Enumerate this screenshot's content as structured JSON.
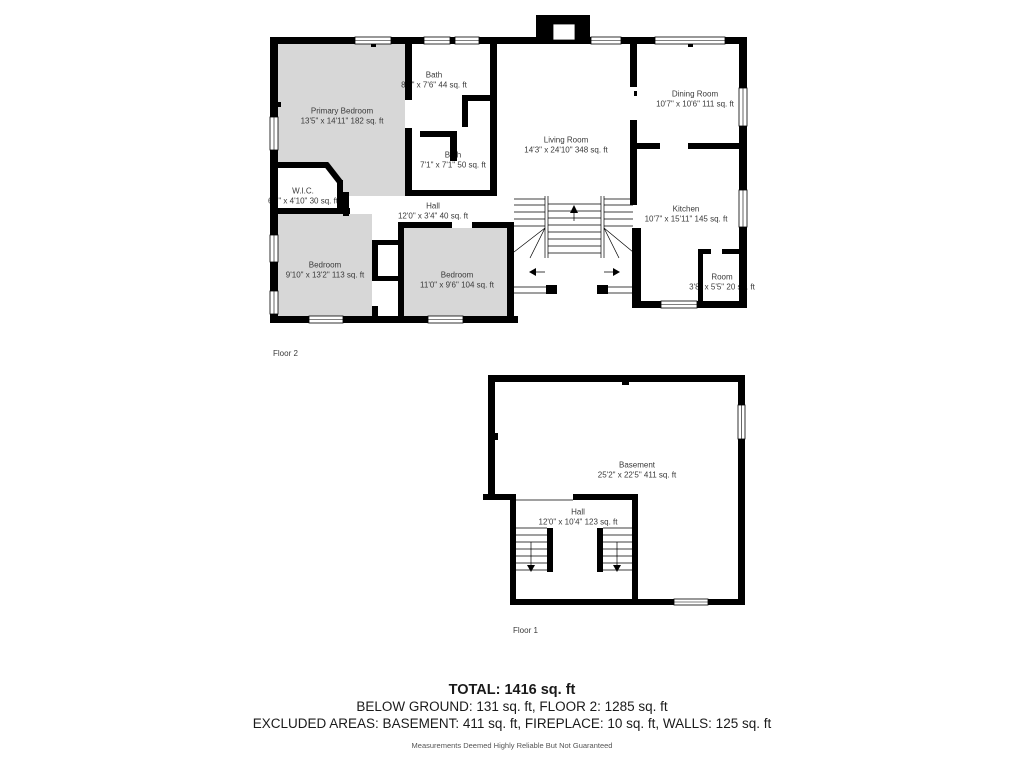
{
  "floor2": {
    "label": "Floor 2",
    "rooms": [
      {
        "name": "Primary Bedroom",
        "dims": "13'5\" x 14'11\" 182 sq. ft"
      },
      {
        "name": "Bath",
        "dims": "8'2\" x 7'6\" 44 sq. ft"
      },
      {
        "name": "Bath",
        "dims": "7'1\" x 7'1\" 50 sq. ft"
      },
      {
        "name": "W.I.C.",
        "dims": "6'7\" x 4'10\" 30 sq. ft"
      },
      {
        "name": "Hall",
        "dims": "12'0\" x 3'4\" 40 sq. ft"
      },
      {
        "name": "Living Room",
        "dims": "14'3\" x 24'10\" 348 sq. ft"
      },
      {
        "name": "Dining Room",
        "dims": "10'7\" x 10'6\" 111 sq. ft"
      },
      {
        "name": "Kitchen",
        "dims": "10'7\" x 15'11\" 145 sq. ft"
      },
      {
        "name": "Bedroom",
        "dims": "9'10\" x 13'2\" 113 sq. ft"
      },
      {
        "name": "Bedroom",
        "dims": "11'0\" x 9'6\" 104 sq. ft"
      },
      {
        "name": "Room",
        "dims": "3'8\" x 5'5\" 20 sq. ft"
      }
    ]
  },
  "floor1": {
    "label": "Floor 1",
    "rooms": [
      {
        "name": "Basement",
        "dims": "25'2\" x 22'5\" 411 sq. ft"
      },
      {
        "name": "Hall",
        "dims": "12'0\" x 10'4\" 123 sq. ft"
      }
    ]
  },
  "summary": {
    "total": "TOTAL: 1416 sq. ft",
    "floors": "BELOW GROUND: 131 sq. ft, FLOOR 2: 1285 sq. ft",
    "excluded": "EXCLUDED AREAS: BASEMENT: 411 sq. ft, FIREPLACE: 10 sq. ft, WALLS: 125 sq. ft",
    "disclaimer": "Measurements Deemed Highly Reliable But Not Guaranteed"
  },
  "colors": {
    "wall": "#000000",
    "room_fill": "#d7d7d7",
    "label_text": "#3a3a3a",
    "summary_text": "#1a1a1a",
    "disclaimer_text": "#555555"
  }
}
